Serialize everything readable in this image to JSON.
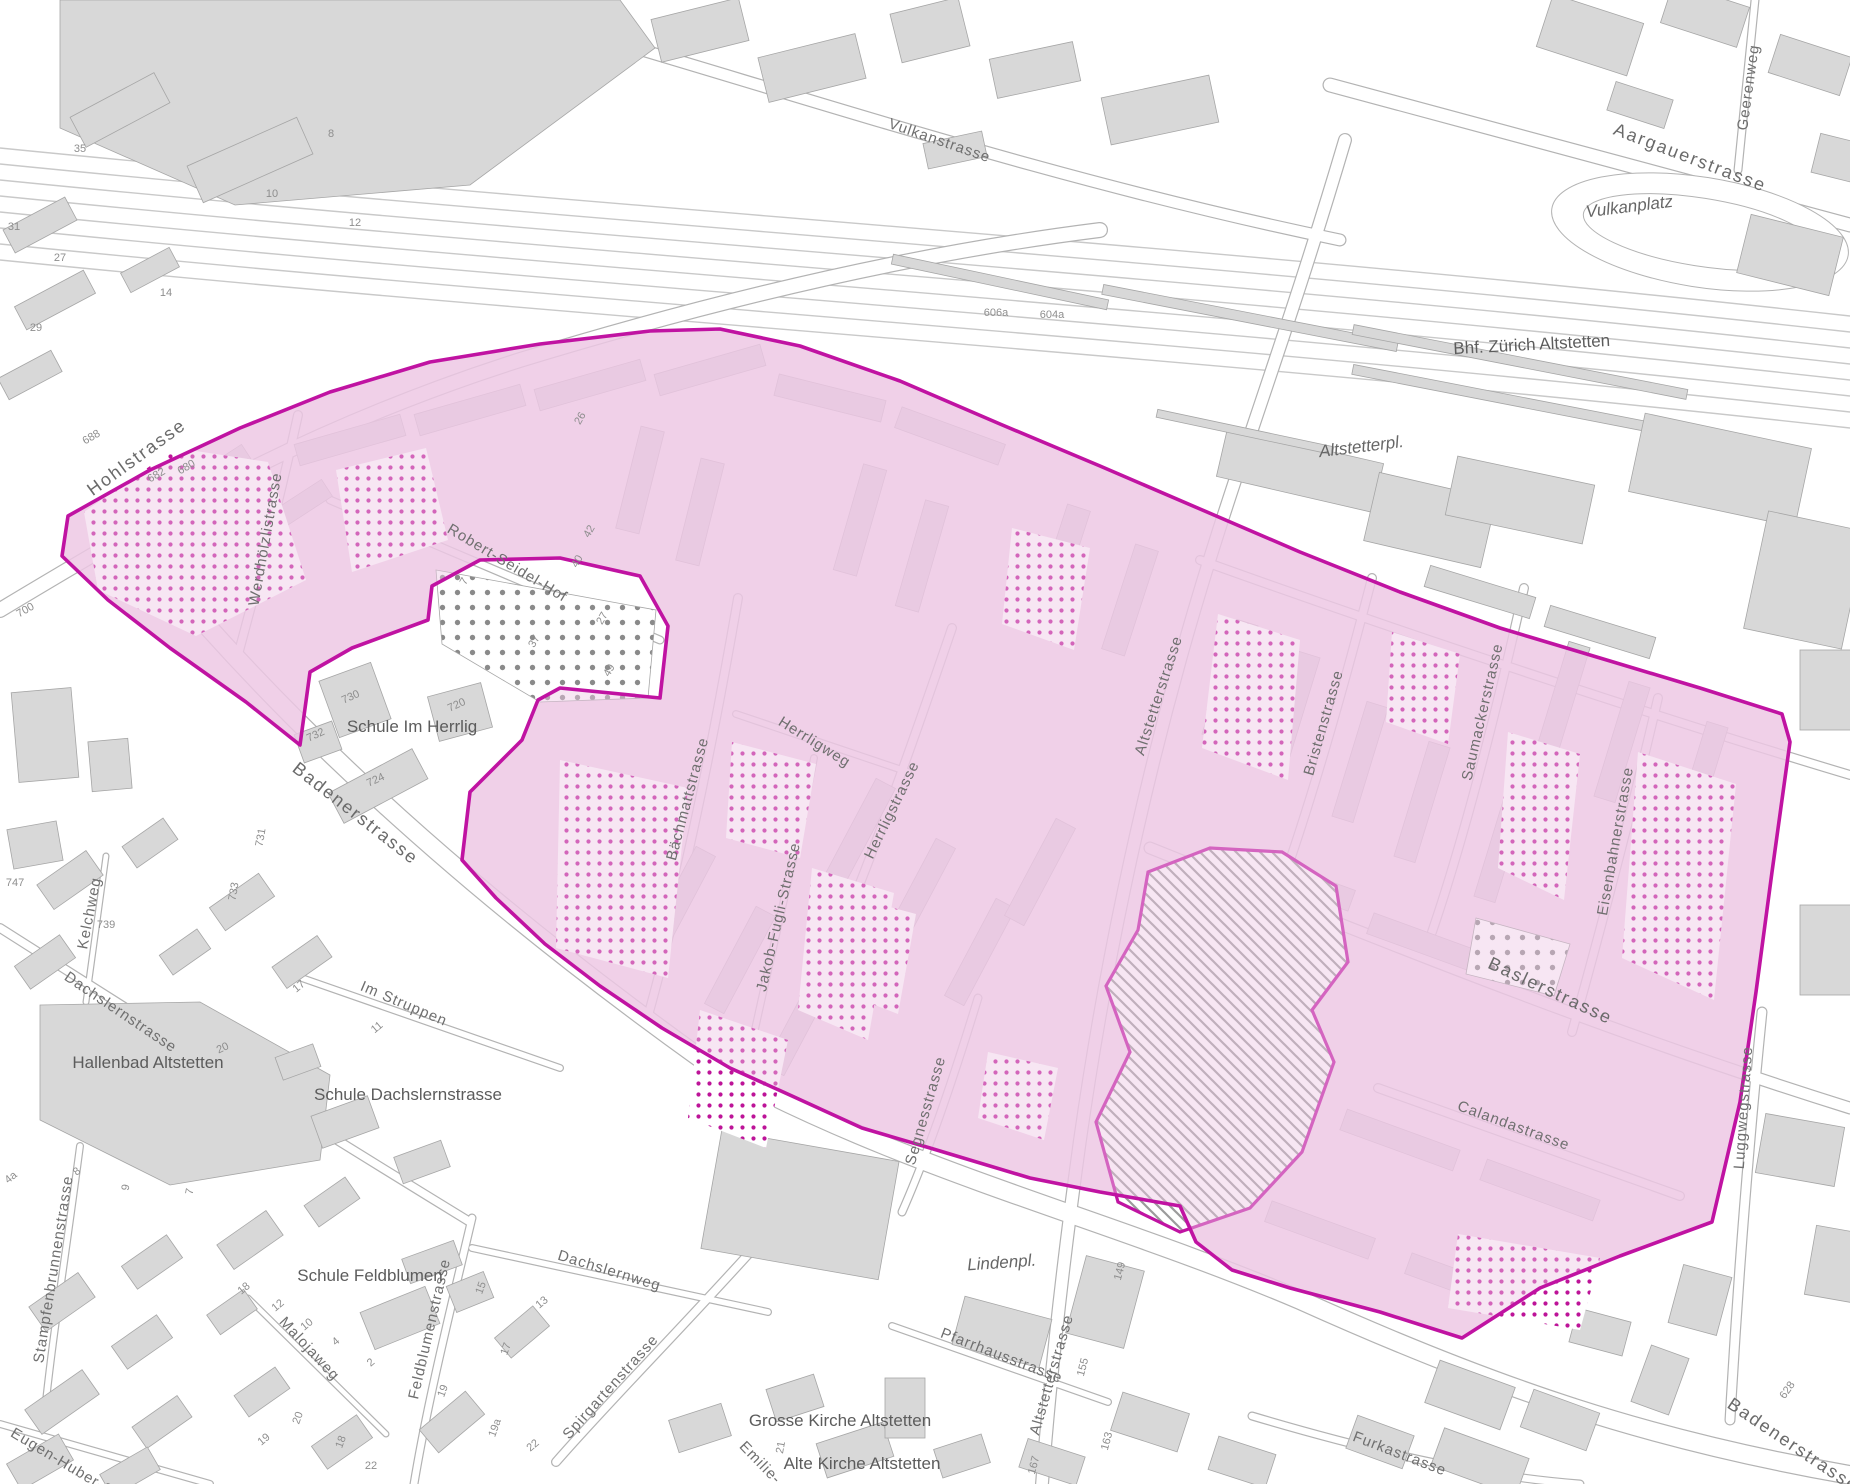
{
  "map": {
    "labels": {
      "streets": [
        {
          "text": "Vulkanstrasse",
          "x": 938,
          "y": 145,
          "r": 19
        },
        {
          "text": "Aargauerstrasse",
          "x": 1688,
          "y": 163,
          "r": 21,
          "big": 1
        },
        {
          "text": "Geerenweg",
          "x": 1753,
          "y": 88,
          "r": -82
        },
        {
          "text": "Hohlstrasse",
          "x": 140,
          "y": 462,
          "r": -36,
          "big": 1
        },
        {
          "text": "Werdhölzlistrasse",
          "x": 270,
          "y": 540,
          "r": -80
        },
        {
          "text": "Robert-Seidel-Hof",
          "x": 505,
          "y": 567,
          "r": 31
        },
        {
          "text": "Badenerstrasse",
          "x": 352,
          "y": 818,
          "r": 38,
          "big": 1
        },
        {
          "text": "Bächmattstrasse",
          "x": 692,
          "y": 800,
          "r": -75
        },
        {
          "text": "Herrligweg",
          "x": 812,
          "y": 746,
          "r": 32
        },
        {
          "text": "Herrligstrasse",
          "x": 896,
          "y": 812,
          "r": -64
        },
        {
          "text": "Jakob-Fugli-Strasse",
          "x": 783,
          "y": 918,
          "r": -77
        },
        {
          "text": "Segnesstrasse",
          "x": 930,
          "y": 1112,
          "r": -74
        },
        {
          "text": "Altstetterstrasse",
          "x": 1163,
          "y": 697,
          "r": -72
        },
        {
          "text": "Bristenstrasse",
          "x": 1328,
          "y": 724,
          "r": -74
        },
        {
          "text": "Saumackerstrasse",
          "x": 1487,
          "y": 713,
          "r": -77
        },
        {
          "text": "Eisenbahnerstrasse",
          "x": 1620,
          "y": 842,
          "r": -80
        },
        {
          "text": "Baslerstrasse",
          "x": 1548,
          "y": 996,
          "r": 25,
          "big": 1
        },
        {
          "text": "Calandastrasse",
          "x": 1512,
          "y": 1130,
          "r": 20
        },
        {
          "text": "Luggwegstrasse",
          "x": 1748,
          "y": 1108,
          "r": -86
        },
        {
          "text": "Altstetterstrasse",
          "x": 1056,
          "y": 1376,
          "r": -74
        },
        {
          "text": "Pfarrhausstrasse",
          "x": 1000,
          "y": 1360,
          "r": 21
        },
        {
          "text": "Spirgartenstrasse",
          "x": 614,
          "y": 1390,
          "r": -48
        },
        {
          "text": "Dachslernweg",
          "x": 608,
          "y": 1275,
          "r": 17
        },
        {
          "text": "Feldblumenstrasse",
          "x": 434,
          "y": 1330,
          "r": -77
        },
        {
          "text": "Malojaweg",
          "x": 306,
          "y": 1352,
          "r": 47
        },
        {
          "text": "Dachslernstrasse",
          "x": 118,
          "y": 1016,
          "r": 34
        },
        {
          "text": "Im Struppen",
          "x": 402,
          "y": 1008,
          "r": 23
        },
        {
          "text": "Kelchweg",
          "x": 94,
          "y": 914,
          "r": -79
        },
        {
          "text": "Stampfenbrunnenstrasse",
          "x": 58,
          "y": 1270,
          "r": -81
        },
        {
          "text": "Eugen-Huber-Strasse",
          "x": 80,
          "y": 1478,
          "r": 31
        },
        {
          "text": "Furkastrasse",
          "x": 1398,
          "y": 1458,
          "r": 21
        },
        {
          "text": "Badenerstrasse",
          "x": 1790,
          "y": 1450,
          "r": 34,
          "big": 1
        },
        {
          "text": "Emilie-",
          "x": 757,
          "y": 1466,
          "r": 46
        }
      ],
      "places": [
        {
          "text": "Vulkanplatz",
          "x": 1630,
          "y": 212,
          "r": -7,
          "italic": 1
        },
        {
          "text": "Bhf. Zürich Altstetten",
          "x": 1532,
          "y": 350,
          "r": -3
        },
        {
          "text": "Altstetterpl.",
          "x": 1362,
          "y": 452,
          "r": -7,
          "italic": 1
        },
        {
          "text": "Schule Im Herrlig",
          "x": 412,
          "y": 732,
          "r": 0
        },
        {
          "text": "Hallenbad Altstetten",
          "x": 148,
          "y": 1068,
          "r": 0
        },
        {
          "text": "Schule Dachslernstrasse",
          "x": 408,
          "y": 1100,
          "r": 0
        },
        {
          "text": "Schule Feldblumen",
          "x": 370,
          "y": 1281,
          "r": 0
        },
        {
          "text": "Grosse Kirche Altstetten",
          "x": 840,
          "y": 1426,
          "r": 0
        },
        {
          "text": "Alte Kirche Altstetten",
          "x": 862,
          "y": 1469,
          "r": 0
        },
        {
          "text": "Lindenpl.",
          "x": 1002,
          "y": 1268,
          "r": -4,
          "italic": 1
        }
      ],
      "numbers": [
        {
          "text": "8",
          "x": 331,
          "y": 137,
          "r": 0
        },
        {
          "text": "10",
          "x": 272,
          "y": 197,
          "r": 0
        },
        {
          "text": "12",
          "x": 355,
          "y": 226,
          "r": 0
        },
        {
          "text": "35",
          "x": 80,
          "y": 152,
          "r": 0
        },
        {
          "text": "31",
          "x": 14,
          "y": 230,
          "r": 0
        },
        {
          "text": "27",
          "x": 60,
          "y": 261,
          "r": 0
        },
        {
          "text": "29",
          "x": 36,
          "y": 331,
          "r": 0
        },
        {
          "text": "14",
          "x": 166,
          "y": 296,
          "r": 0
        },
        {
          "text": "606a",
          "x": 996,
          "y": 316,
          "r": 0
        },
        {
          "text": "604a",
          "x": 1052,
          "y": 318,
          "r": 0
        },
        {
          "text": "688",
          "x": 93,
          "y": 440,
          "r": -30
        },
        {
          "text": "682",
          "x": 158,
          "y": 478,
          "r": -30
        },
        {
          "text": "680",
          "x": 188,
          "y": 470,
          "r": -30
        },
        {
          "text": "700",
          "x": 27,
          "y": 613,
          "r": -30
        },
        {
          "text": "747",
          "x": 15,
          "y": 886,
          "r": 0
        },
        {
          "text": "739",
          "x": 106,
          "y": 928,
          "r": 0
        },
        {
          "text": "26",
          "x": 583,
          "y": 420,
          "r": -60
        },
        {
          "text": "42",
          "x": 592,
          "y": 533,
          "r": -60
        },
        {
          "text": "40",
          "x": 580,
          "y": 563,
          "r": -60
        },
        {
          "text": "27",
          "x": 605,
          "y": 620,
          "r": -60
        },
        {
          "text": "37",
          "x": 537,
          "y": 643,
          "r": -60
        },
        {
          "text": "49",
          "x": 612,
          "y": 672,
          "r": -60
        },
        {
          "text": "7",
          "x": 467,
          "y": 583,
          "r": -60
        },
        {
          "text": "730",
          "x": 352,
          "y": 700,
          "r": -25
        },
        {
          "text": "720",
          "x": 458,
          "y": 708,
          "r": -25
        },
        {
          "text": "732",
          "x": 317,
          "y": 738,
          "r": -25
        },
        {
          "text": "724",
          "x": 377,
          "y": 783,
          "r": -25
        },
        {
          "text": "731",
          "x": 264,
          "y": 838,
          "r": -80
        },
        {
          "text": "733",
          "x": 237,
          "y": 892,
          "r": -80
        },
        {
          "text": "149",
          "x": 1123,
          "y": 1272,
          "r": -75
        },
        {
          "text": "155",
          "x": 1086,
          "y": 1368,
          "r": -75
        },
        {
          "text": "163",
          "x": 1110,
          "y": 1442,
          "r": -75
        },
        {
          "text": "167",
          "x": 1037,
          "y": 1466,
          "r": -75
        },
        {
          "text": "628",
          "x": 1790,
          "y": 1392,
          "r": -55
        },
        {
          "text": "17",
          "x": 301,
          "y": 989,
          "r": -40
        },
        {
          "text": "11",
          "x": 379,
          "y": 1030,
          "r": -40
        },
        {
          "text": "20",
          "x": 224,
          "y": 1051,
          "r": -25
        },
        {
          "text": "8",
          "x": 79,
          "y": 1174,
          "r": -40
        },
        {
          "text": "4a",
          "x": 13,
          "y": 1180,
          "r": -40
        },
        {
          "text": "9",
          "x": 129,
          "y": 1188,
          "r": -80
        },
        {
          "text": "7",
          "x": 193,
          "y": 1192,
          "r": -80
        },
        {
          "text": "18",
          "x": 246,
          "y": 1291,
          "r": -40
        },
        {
          "text": "12",
          "x": 280,
          "y": 1308,
          "r": -40
        },
        {
          "text": "10",
          "x": 309,
          "y": 1327,
          "r": -40
        },
        {
          "text": "4",
          "x": 338,
          "y": 1344,
          "r": -40
        },
        {
          "text": "2",
          "x": 373,
          "y": 1365,
          "r": -40
        },
        {
          "text": "15",
          "x": 484,
          "y": 1289,
          "r": -70
        },
        {
          "text": "13",
          "x": 544,
          "y": 1305,
          "r": -40
        },
        {
          "text": "17",
          "x": 509,
          "y": 1350,
          "r": -70
        },
        {
          "text": "19",
          "x": 446,
          "y": 1392,
          "r": -70
        },
        {
          "text": "19a",
          "x": 498,
          "y": 1429,
          "r": -70
        },
        {
          "text": "22",
          "x": 535,
          "y": 1448,
          "r": -40
        },
        {
          "text": "20",
          "x": 301,
          "y": 1419,
          "r": -70
        },
        {
          "text": "19",
          "x": 266,
          "y": 1442,
          "r": -40
        },
        {
          "text": "18",
          "x": 344,
          "y": 1443,
          "r": -70
        },
        {
          "text": "22",
          "x": 371,
          "y": 1469,
          "r": 0
        },
        {
          "text": "21",
          "x": 784,
          "y": 1448,
          "r": -80
        }
      ]
    },
    "colors": {
      "zone_magenta": "#c013a2",
      "zone_dot_magenta": "#bd1498",
      "pink_wash": "#f7e4f2",
      "building_gray": "#d8d8d8",
      "road_casing_gray": "#b3b3b3",
      "excluded_hatch_gray": "#9b9b9b",
      "gray_dots": "#8a8a8a",
      "label_gray": "#6f6f6f"
    }
  }
}
